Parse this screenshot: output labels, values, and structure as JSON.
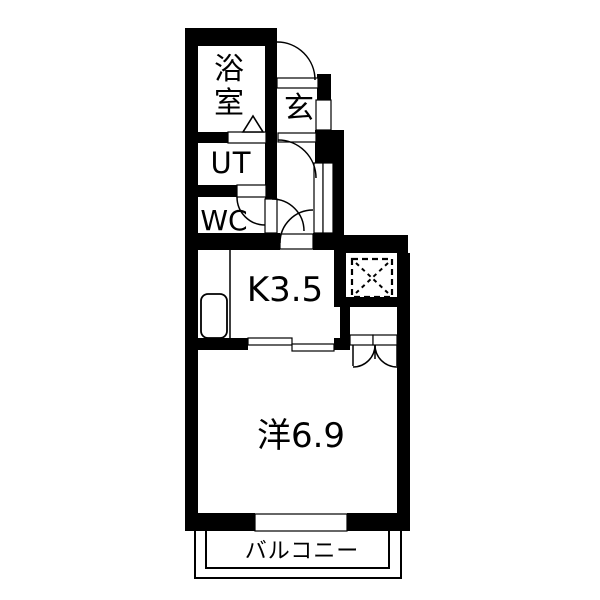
{
  "plan": {
    "rooms": {
      "bathroom": {
        "label": "浴室"
      },
      "entrance": {
        "label": "玄"
      },
      "utility": {
        "label": "UT"
      },
      "toilet": {
        "label": "WC"
      },
      "kitchen": {
        "label": "K3.5"
      },
      "western_room": {
        "label": "洋6.9"
      },
      "balcony": {
        "label": "バルコニー"
      }
    },
    "icons": [
      "washing-machine-space-icon",
      "refrigerator-icon",
      "bathroom-door-triangle-icon",
      "door-swing-arc",
      "double-closet-door",
      "sliding-door",
      "window"
    ],
    "colors": {
      "wall": "#000000",
      "background": "#ffffff",
      "line": "#000000"
    }
  }
}
